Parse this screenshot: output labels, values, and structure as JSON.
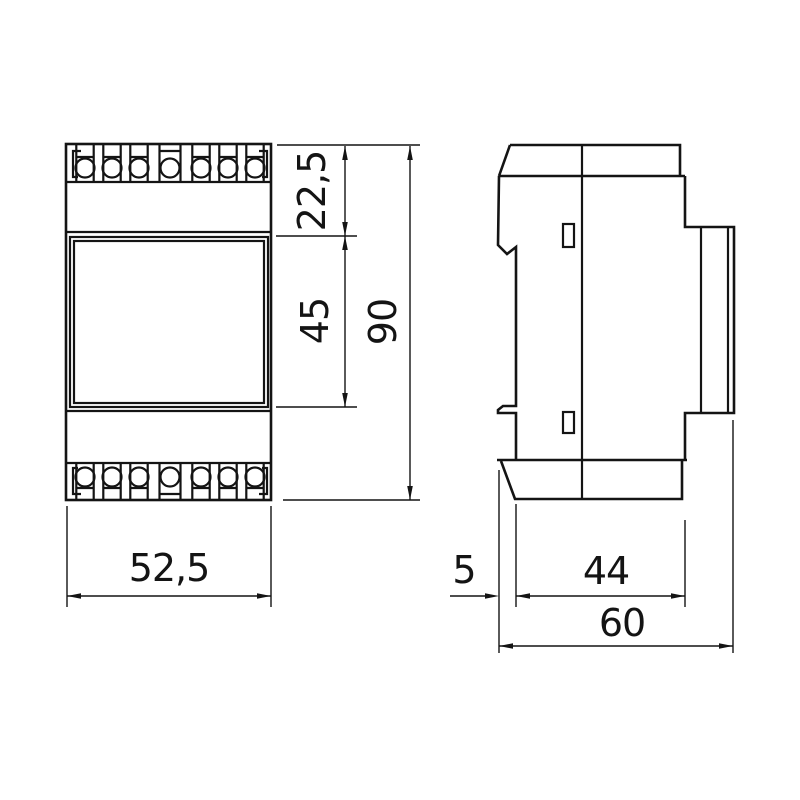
{
  "drawing": {
    "kind": "technical-dimension-drawing",
    "subject": "din-rail-module",
    "views": [
      "front",
      "side"
    ]
  },
  "dimensions": {
    "front_width": "52,5",
    "top_section_height": "22,5",
    "middle_section_height": "45",
    "total_height": "90",
    "clip_offset_depth": "5",
    "body_depth": "44",
    "total_depth": "60"
  },
  "colors": {
    "line": "#141414",
    "background": "#ffffff"
  }
}
